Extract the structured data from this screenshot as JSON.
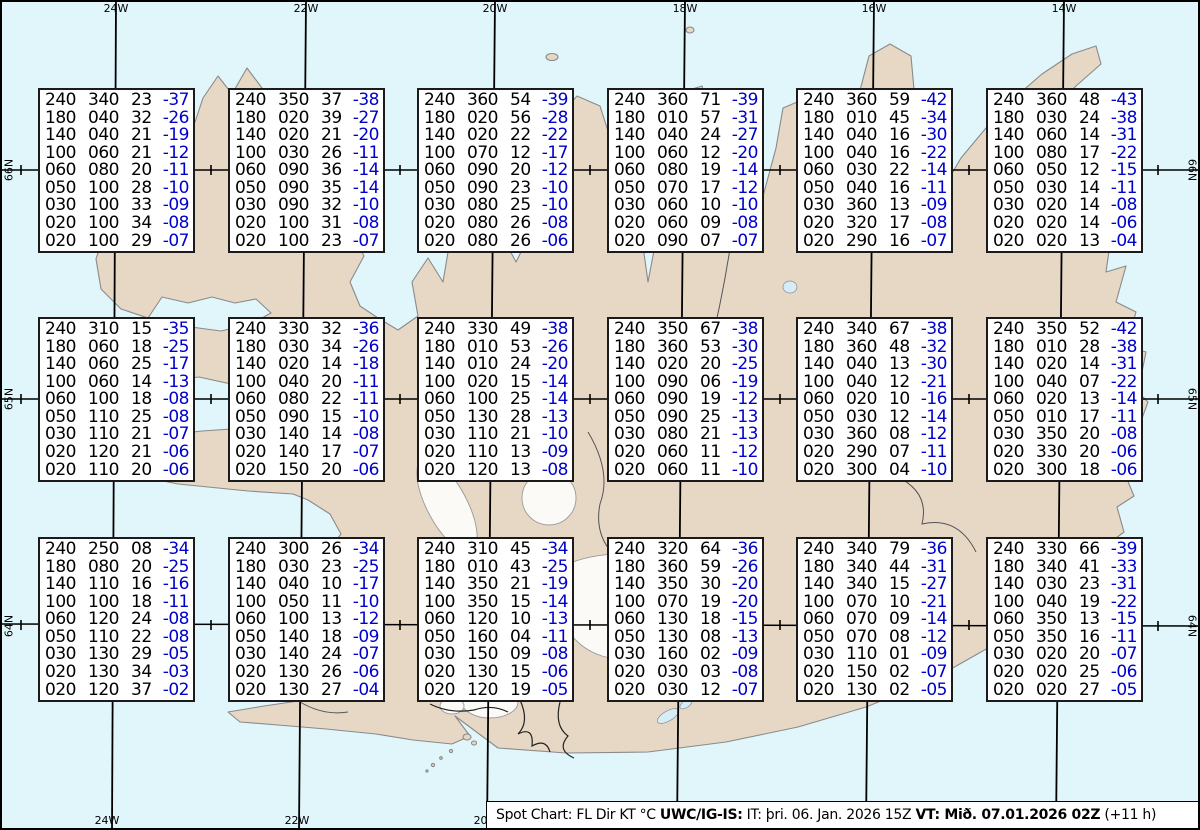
{
  "title": "Spot Chart",
  "map": {
    "region": "Iceland",
    "meridians": [
      {
        "label": "24W",
        "x": 116,
        "bottom_label": true
      },
      {
        "label": "22W",
        "x": 306,
        "bottom_label": true
      },
      {
        "label": "20W",
        "x": 495,
        "bottom_label": true
      },
      {
        "label": "18W",
        "x": 685,
        "bottom_label": false
      },
      {
        "label": "16W",
        "x": 874,
        "bottom_label": false
      },
      {
        "label": "14W",
        "x": 1064,
        "bottom_label": false
      }
    ],
    "parallels": [
      {
        "label": "66N",
        "y": 170
      },
      {
        "label": "65N",
        "y": 399
      },
      {
        "label": "64N",
        "y": 626
      }
    ]
  },
  "colors": {
    "water": "#e0f6fb",
    "land": "#e7d8c6",
    "coastline": "#8a8a8a",
    "glacier": "#fbfaf6",
    "lake": "#d4edf8",
    "grid": "#000000",
    "box_background": "#ffffff",
    "box_border": "#1b1b1b",
    "data_text": "#000000",
    "temperature_text": "#0000cd"
  },
  "columns_legend": [
    "FL",
    "Dir",
    "KT",
    "°C"
  ],
  "footer": {
    "segments": [
      {
        "text": "Spot Chart: FL Dir KT °C ",
        "bold": false
      },
      {
        "text": "UWC/IG-IS:",
        "bold": true
      },
      {
        "text": " IT: þri. 06. Jan. 2026 15Z ",
        "bold": false
      },
      {
        "text": "VT: Mið. 07.01.2026 02Z",
        "bold": true
      },
      {
        "text": " (+11 h)",
        "bold": false
      }
    ]
  },
  "spot_boxes": [
    {
      "rows": [
        [
          "240",
          "340",
          "23",
          "-37"
        ],
        [
          "180",
          "040",
          "32",
          "-26"
        ],
        [
          "140",
          "040",
          "21",
          "-19"
        ],
        [
          "100",
          "060",
          "21",
          "-12"
        ],
        [
          "060",
          "080",
          "20",
          "-11"
        ],
        [
          "050",
          "100",
          "28",
          "-10"
        ],
        [
          "030",
          "100",
          "33",
          "-09"
        ],
        [
          "020",
          "100",
          "34",
          "-08"
        ],
        [
          "020",
          "100",
          "29",
          "-07"
        ]
      ]
    },
    {
      "rows": [
        [
          "240",
          "350",
          "37",
          "-38"
        ],
        [
          "180",
          "020",
          "39",
          "-27"
        ],
        [
          "140",
          "020",
          "21",
          "-20"
        ],
        [
          "100",
          "030",
          "26",
          "-11"
        ],
        [
          "060",
          "090",
          "36",
          "-14"
        ],
        [
          "050",
          "090",
          "35",
          "-14"
        ],
        [
          "030",
          "090",
          "32",
          "-10"
        ],
        [
          "020",
          "100",
          "31",
          "-08"
        ],
        [
          "020",
          "100",
          "23",
          "-07"
        ]
      ]
    },
    {
      "rows": [
        [
          "240",
          "360",
          "54",
          "-39"
        ],
        [
          "180",
          "020",
          "56",
          "-28"
        ],
        [
          "140",
          "020",
          "22",
          "-22"
        ],
        [
          "100",
          "070",
          "12",
          "-17"
        ],
        [
          "060",
          "090",
          "20",
          "-12"
        ],
        [
          "050",
          "090",
          "23",
          "-10"
        ],
        [
          "030",
          "080",
          "25",
          "-10"
        ],
        [
          "020",
          "080",
          "26",
          "-08"
        ],
        [
          "020",
          "080",
          "26",
          "-06"
        ]
      ]
    },
    {
      "rows": [
        [
          "240",
          "360",
          "71",
          "-39"
        ],
        [
          "180",
          "010",
          "57",
          "-31"
        ],
        [
          "140",
          "040",
          "24",
          "-27"
        ],
        [
          "100",
          "060",
          "12",
          "-20"
        ],
        [
          "060",
          "080",
          "19",
          "-14"
        ],
        [
          "050",
          "070",
          "17",
          "-12"
        ],
        [
          "030",
          "060",
          "10",
          "-10"
        ],
        [
          "020",
          "060",
          "09",
          "-08"
        ],
        [
          "020",
          "090",
          "07",
          "-07"
        ]
      ]
    },
    {
      "rows": [
        [
          "240",
          "360",
          "59",
          "-42"
        ],
        [
          "180",
          "010",
          "45",
          "-34"
        ],
        [
          "140",
          "040",
          "16",
          "-30"
        ],
        [
          "100",
          "040",
          "16",
          "-22"
        ],
        [
          "060",
          "030",
          "22",
          "-14"
        ],
        [
          "050",
          "040",
          "16",
          "-11"
        ],
        [
          "030",
          "360",
          "13",
          "-09"
        ],
        [
          "020",
          "320",
          "17",
          "-08"
        ],
        [
          "020",
          "290",
          "16",
          "-07"
        ]
      ]
    },
    {
      "rows": [
        [
          "240",
          "360",
          "48",
          "-43"
        ],
        [
          "180",
          "030",
          "24",
          "-38"
        ],
        [
          "140",
          "060",
          "14",
          "-31"
        ],
        [
          "100",
          "080",
          "17",
          "-22"
        ],
        [
          "060",
          "050",
          "12",
          "-15"
        ],
        [
          "050",
          "030",
          "14",
          "-11"
        ],
        [
          "030",
          "020",
          "14",
          "-08"
        ],
        [
          "020",
          "020",
          "14",
          "-06"
        ],
        [
          "020",
          "020",
          "13",
          "-04"
        ]
      ]
    },
    {
      "rows": [
        [
          "240",
          "310",
          "15",
          "-35"
        ],
        [
          "180",
          "060",
          "18",
          "-25"
        ],
        [
          "140",
          "060",
          "25",
          "-17"
        ],
        [
          "100",
          "060",
          "14",
          "-13"
        ],
        [
          "060",
          "100",
          "18",
          "-08"
        ],
        [
          "050",
          "110",
          "25",
          "-08"
        ],
        [
          "030",
          "110",
          "21",
          "-07"
        ],
        [
          "020",
          "120",
          "21",
          "-06"
        ],
        [
          "020",
          "110",
          "20",
          "-06"
        ]
      ]
    },
    {
      "rows": [
        [
          "240",
          "330",
          "32",
          "-36"
        ],
        [
          "180",
          "030",
          "34",
          "-26"
        ],
        [
          "140",
          "020",
          "14",
          "-18"
        ],
        [
          "100",
          "040",
          "20",
          "-11"
        ],
        [
          "060",
          "080",
          "22",
          "-11"
        ],
        [
          "050",
          "090",
          "15",
          "-10"
        ],
        [
          "030",
          "140",
          "14",
          "-08"
        ],
        [
          "020",
          "140",
          "17",
          "-07"
        ],
        [
          "020",
          "150",
          "20",
          "-06"
        ]
      ]
    },
    {
      "rows": [
        [
          "240",
          "330",
          "49",
          "-38"
        ],
        [
          "180",
          "010",
          "53",
          "-26"
        ],
        [
          "140",
          "010",
          "24",
          "-20"
        ],
        [
          "100",
          "020",
          "15",
          "-14"
        ],
        [
          "060",
          "100",
          "25",
          "-14"
        ],
        [
          "050",
          "130",
          "28",
          "-13"
        ],
        [
          "030",
          "110",
          "21",
          "-10"
        ],
        [
          "020",
          "110",
          "13",
          "-09"
        ],
        [
          "020",
          "120",
          "13",
          "-08"
        ]
      ]
    },
    {
      "rows": [
        [
          "240",
          "350",
          "67",
          "-38"
        ],
        [
          "180",
          "360",
          "53",
          "-30"
        ],
        [
          "140",
          "020",
          "20",
          "-25"
        ],
        [
          "100",
          "090",
          "06",
          "-19"
        ],
        [
          "060",
          "090",
          "19",
          "-12"
        ],
        [
          "050",
          "090",
          "25",
          "-13"
        ],
        [
          "030",
          "080",
          "21",
          "-13"
        ],
        [
          "020",
          "060",
          "11",
          "-12"
        ],
        [
          "020",
          "060",
          "11",
          "-10"
        ]
      ]
    },
    {
      "rows": [
        [
          "240",
          "340",
          "67",
          "-38"
        ],
        [
          "180",
          "360",
          "48",
          "-32"
        ],
        [
          "140",
          "040",
          "13",
          "-30"
        ],
        [
          "100",
          "040",
          "12",
          "-21"
        ],
        [
          "060",
          "020",
          "10",
          "-16"
        ],
        [
          "050",
          "030",
          "12",
          "-14"
        ],
        [
          "030",
          "360",
          "08",
          "-12"
        ],
        [
          "020",
          "290",
          "07",
          "-11"
        ],
        [
          "020",
          "300",
          "04",
          "-10"
        ]
      ]
    },
    {
      "rows": [
        [
          "240",
          "350",
          "52",
          "-42"
        ],
        [
          "180",
          "010",
          "28",
          "-38"
        ],
        [
          "140",
          "020",
          "14",
          "-31"
        ],
        [
          "100",
          "040",
          "07",
          "-22"
        ],
        [
          "060",
          "020",
          "13",
          "-14"
        ],
        [
          "050",
          "010",
          "17",
          "-11"
        ],
        [
          "030",
          "350",
          "20",
          "-08"
        ],
        [
          "020",
          "330",
          "20",
          "-06"
        ],
        [
          "020",
          "300",
          "18",
          "-06"
        ]
      ]
    },
    {
      "rows": [
        [
          "240",
          "250",
          "08",
          "-34"
        ],
        [
          "180",
          "080",
          "20",
          "-25"
        ],
        [
          "140",
          "110",
          "16",
          "-16"
        ],
        [
          "100",
          "100",
          "18",
          "-11"
        ],
        [
          "060",
          "120",
          "24",
          "-08"
        ],
        [
          "050",
          "110",
          "22",
          "-08"
        ],
        [
          "030",
          "130",
          "29",
          "-05"
        ],
        [
          "020",
          "130",
          "34",
          "-03"
        ],
        [
          "020",
          "120",
          "37",
          "-02"
        ]
      ]
    },
    {
      "rows": [
        [
          "240",
          "300",
          "26",
          "-34"
        ],
        [
          "180",
          "030",
          "23",
          "-25"
        ],
        [
          "140",
          "040",
          "10",
          "-17"
        ],
        [
          "100",
          "050",
          "11",
          "-10"
        ],
        [
          "060",
          "100",
          "13",
          "-12"
        ],
        [
          "050",
          "140",
          "18",
          "-09"
        ],
        [
          "030",
          "140",
          "24",
          "-07"
        ],
        [
          "020",
          "130",
          "26",
          "-06"
        ],
        [
          "020",
          "130",
          "27",
          "-04"
        ]
      ]
    },
    {
      "rows": [
        [
          "240",
          "310",
          "45",
          "-34"
        ],
        [
          "180",
          "010",
          "43",
          "-25"
        ],
        [
          "140",
          "350",
          "21",
          "-19"
        ],
        [
          "100",
          "350",
          "15",
          "-14"
        ],
        [
          "060",
          "120",
          "10",
          "-13"
        ],
        [
          "050",
          "160",
          "04",
          "-11"
        ],
        [
          "030",
          "150",
          "09",
          "-08"
        ],
        [
          "020",
          "130",
          "15",
          "-06"
        ],
        [
          "020",
          "120",
          "19",
          "-05"
        ]
      ]
    },
    {
      "rows": [
        [
          "240",
          "320",
          "64",
          "-36"
        ],
        [
          "180",
          "360",
          "59",
          "-26"
        ],
        [
          "140",
          "350",
          "30",
          "-20"
        ],
        [
          "100",
          "070",
          "19",
          "-20"
        ],
        [
          "060",
          "130",
          "18",
          "-15"
        ],
        [
          "050",
          "130",
          "08",
          "-13"
        ],
        [
          "030",
          "160",
          "02",
          "-09"
        ],
        [
          "020",
          "030",
          "03",
          "-08"
        ],
        [
          "020",
          "030",
          "12",
          "-07"
        ]
      ]
    },
    {
      "rows": [
        [
          "240",
          "340",
          "79",
          "-36"
        ],
        [
          "180",
          "340",
          "44",
          "-31"
        ],
        [
          "140",
          "340",
          "15",
          "-27"
        ],
        [
          "100",
          "070",
          "10",
          "-21"
        ],
        [
          "060",
          "070",
          "09",
          "-14"
        ],
        [
          "050",
          "070",
          "08",
          "-12"
        ],
        [
          "030",
          "110",
          "01",
          "-09"
        ],
        [
          "020",
          "150",
          "02",
          "-07"
        ],
        [
          "020",
          "130",
          "02",
          "-05"
        ]
      ]
    },
    {
      "rows": [
        [
          "240",
          "330",
          "66",
          "-39"
        ],
        [
          "180",
          "340",
          "41",
          "-33"
        ],
        [
          "140",
          "030",
          "23",
          "-31"
        ],
        [
          "100",
          "040",
          "19",
          "-22"
        ],
        [
          "060",
          "350",
          "13",
          "-15"
        ],
        [
          "050",
          "350",
          "16",
          "-11"
        ],
        [
          "030",
          "020",
          "20",
          "-07"
        ],
        [
          "020",
          "020",
          "25",
          "-06"
        ],
        [
          "020",
          "020",
          "27",
          "-05"
        ]
      ]
    }
  ]
}
